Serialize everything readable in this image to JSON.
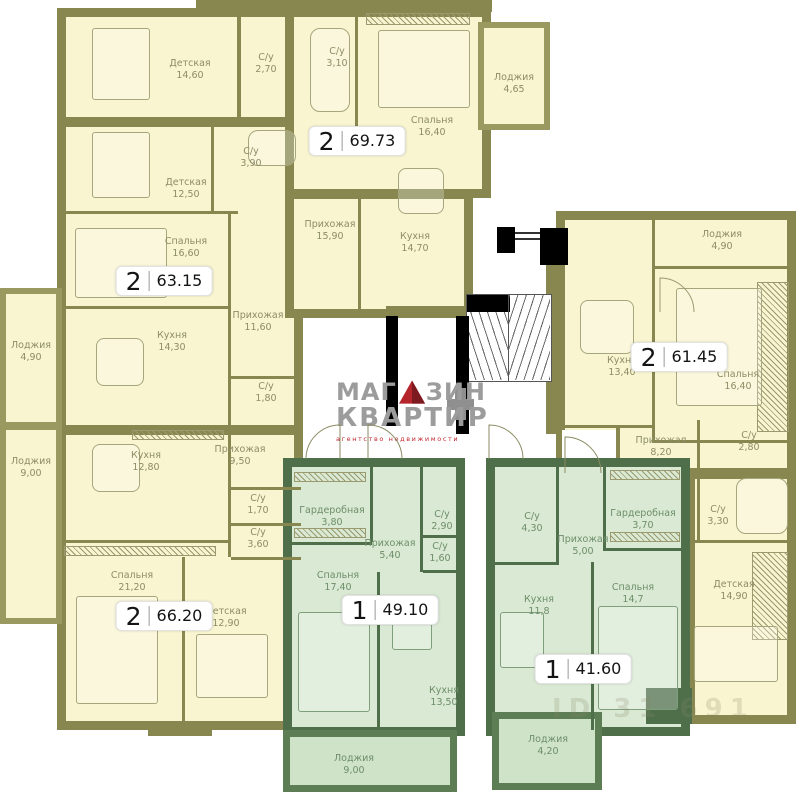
{
  "logo": {
    "brand_top_left": "МАГ",
    "brand_top_right": "ЗИН",
    "brand_bottom": "КВАРТИР",
    "tagline": "агентство  недвижимости",
    "accent_red": "#c1272d",
    "gray": "#9c9c9c"
  },
  "watermark": "ID 31 691",
  "colors": {
    "wall_olive": "#87874f",
    "room_fill_yellow": "#f8f5d0",
    "wall_green": "#4f6f4b",
    "room_fill_green": "#d9e9d3",
    "elevator_black": "#000000",
    "badge_bg": "#ffffff"
  },
  "apartments": [
    {
      "type": "2",
      "total": "69.73",
      "rooms": [
        {
          "name": "Детская",
          "area": "14,60"
        },
        {
          "name": "С/у",
          "area": "2,70"
        },
        {
          "name": "С/у",
          "area": "3,10"
        },
        {
          "name": "Спальня",
          "area": "16,40"
        },
        {
          "name": "Лоджия",
          "area": "4,65"
        },
        {
          "name": "Прихожая",
          "area": "15,90"
        },
        {
          "name": "Кухня",
          "area": "14,70"
        }
      ]
    },
    {
      "type": "2",
      "total": "63.15",
      "rooms": [
        {
          "name": "Детская",
          "area": "12,50"
        },
        {
          "name": "С/у",
          "area": "3,90"
        },
        {
          "name": "Спальня",
          "area": "16,60"
        },
        {
          "name": "Прихожая",
          "area": "11,60"
        },
        {
          "name": "Кухня",
          "area": "14,30"
        },
        {
          "name": "С/у",
          "area": "1,80"
        },
        {
          "name": "Лоджия",
          "area": "4,90"
        }
      ]
    },
    {
      "type": "2",
      "total": "66.20",
      "rooms": [
        {
          "name": "Прихожая",
          "area": "9,50"
        },
        {
          "name": "Кухня",
          "area": "12,80"
        },
        {
          "name": "Лоджия",
          "area": "9,00"
        },
        {
          "name": "С/у",
          "area": "1,70"
        },
        {
          "name": "С/у",
          "area": "3,60"
        },
        {
          "name": "Спальня",
          "area": "21,20"
        },
        {
          "name": "Детская",
          "area": "12,90"
        }
      ]
    },
    {
      "type": "1",
      "total": "49.10",
      "rooms": [
        {
          "name": "Гардеробная",
          "area": "3,80"
        },
        {
          "name": "Прихожая",
          "area": "5,40"
        },
        {
          "name": "С/у",
          "area": "2,90"
        },
        {
          "name": "С/у",
          "area": "1,60"
        },
        {
          "name": "Спальня",
          "area": "17,40"
        },
        {
          "name": "Кухня",
          "area": "13,50"
        },
        {
          "name": "Лоджия",
          "area": "9,00"
        }
      ]
    },
    {
      "type": "1",
      "total": "41.60",
      "rooms": [
        {
          "name": "С/у",
          "area": "4,30"
        },
        {
          "name": "Прихожая",
          "area": "5,00"
        },
        {
          "name": "Гардеробная",
          "area": "3,70"
        },
        {
          "name": "Кухня",
          "area": "11,8"
        },
        {
          "name": "Спальня",
          "area": "14,7"
        },
        {
          "name": "Лоджия",
          "area": "4,20"
        }
      ]
    },
    {
      "type": "2",
      "total": "61.45",
      "rooms": [
        {
          "name": "Лоджия",
          "area": "4,90"
        },
        {
          "name": "Кухня",
          "area": "13,40"
        },
        {
          "name": "Спальня",
          "area": "16,40"
        },
        {
          "name": "Прихожая",
          "area": "8,20"
        },
        {
          "name": "С/у",
          "area": "2,80"
        },
        {
          "name": "С/у",
          "area": "3,30"
        },
        {
          "name": "Детская",
          "area": "14,90"
        }
      ]
    }
  ]
}
